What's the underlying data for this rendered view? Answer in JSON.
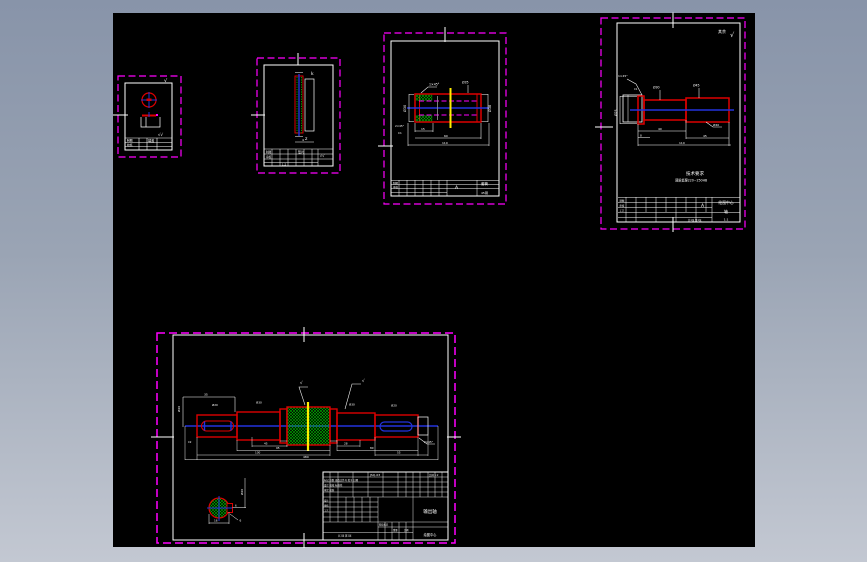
{
  "window": {
    "bg_top": "#8894a9",
    "bg_bottom": "#c3c8d2",
    "canvas_bg": "#000000"
  },
  "palette": {
    "frame_border": "#ff00ff",
    "part_outline": "#dd0000",
    "centerline": "#2233dd",
    "hatch_green": "#00bb00",
    "highlight_yellow": "#ffee00",
    "drawing_white": "#ffffff"
  },
  "frame_a": {
    "rough_corner": "√",
    "rough_block": "√√",
    "tb": {
      "r1": "制图",
      "r2": "校核",
      "name": "端盖"
    }
  },
  "frame_b": {
    "label_top": "k",
    "label_bottom": "z",
    "dim": "4",
    "tb": {
      "r1": "制图",
      "r2": "审核",
      "name": "垫片",
      "rough": "√√",
      "scale": "1:2"
    }
  },
  "frame_c": {
    "dim_left": "Ø30",
    "dim_right": "Ø38",
    "chamfer": "1×45°",
    "dim_top": "Ø35",
    "dim_b1": "15",
    "dim_b2": "60",
    "dim_b3": "110",
    "note1": "2×45°",
    "note2": "C1",
    "tb": {
      "mark": "A",
      "name": "套筒",
      "material": "45钢",
      "r1": "制图",
      "r2": "审核"
    }
  },
  "frame_d": {
    "rough_label": "其余",
    "rough_mark": "√",
    "chamfer": "1×45°",
    "chamfer2": "C1",
    "dim_mid": "Ø30",
    "dim_right": "Ø45",
    "dim_left": "Ø25",
    "dim_leader": "Ø40",
    "dim_b1": "40",
    "dim_b2": "8",
    "dim_b3": "45",
    "dim_overall": "110",
    "tech_title": "技术要求",
    "tech_line": "调质处理220~250HB",
    "tb": {
      "company": "绘图中心",
      "name": "轴",
      "scale": "1:1",
      "mark": "A",
      "r1": "制图",
      "r2": "审核",
      "r3": "工艺",
      "sheet": "共1张 第1张"
    }
  },
  "frame_e": {
    "dim_keyway_pos": "35",
    "dim_rot_left": "Ø20",
    "d_s1": "Ø20",
    "d_s2": "Ø30",
    "d_s5": "Ø30",
    "d_s6": "Ø20",
    "rough1": "√",
    "rough2": "√",
    "chamfer_l": "C2",
    "chamfer_r": "2×45°",
    "b1": "45",
    "b2": "28",
    "b3": "95",
    "b4": "80",
    "b5": "130",
    "b6": "55",
    "overall": "480",
    "sec": {
      "dim_rot": "Ø20",
      "dim_flat": "6",
      "dim_width": "16",
      "leader": "6"
    },
    "tb": {
      "code": "JSQ-03",
      "row2": "标记 处数 更改文件号 签字 日期",
      "row3": "设计 校核 标准化",
      "row4": "审定 批准",
      "scale_top": "比例 1:2",
      "name": "输出轴",
      "company": "绘图中心",
      "l1": "设计",
      "l2": "审核",
      "l3": "工艺",
      "stage": "阶段标记",
      "weight": "重量",
      "scale": "比例",
      "sheet": "共1张 第1张"
    }
  }
}
